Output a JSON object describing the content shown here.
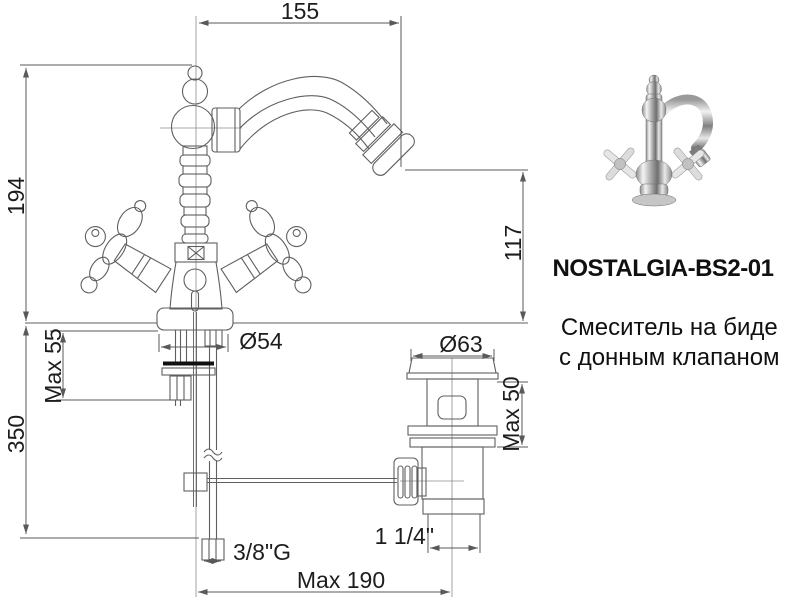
{
  "page": {
    "background": "#ffffff"
  },
  "drawing": {
    "dims": {
      "spout_reach": "155",
      "height_above_deck": "194",
      "spout_height": "117",
      "body_diameter": "Ø54",
      "deck_thickness_max": "Max 55",
      "supply_length": "350",
      "flange_diameter": "Ø63",
      "drain_deck_max": "Max 50",
      "supply_thread": "3/8\"G",
      "drain_thread": "1 1/4\"",
      "rod_reach_max": "Max 190"
    }
  },
  "product": {
    "code": "NOSTALGIA-BS2-01",
    "description": [
      "Смеситель на биде",
      "с донным клапаном"
    ]
  },
  "colors": {
    "object_line": "#5f5f5f",
    "dim_line": "#595959",
    "centerline": "#8c8c8c",
    "text": "#1d1d1d",
    "gasket": "#111111",
    "background": "#ffffff"
  }
}
